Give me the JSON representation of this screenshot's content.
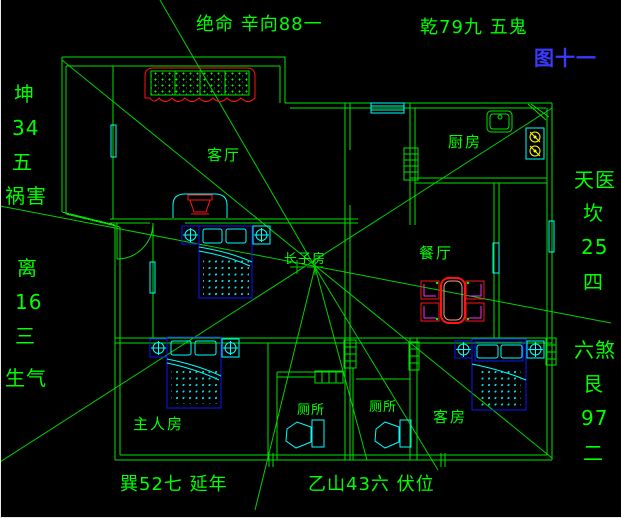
{
  "annotations": {
    "top_left": "绝命 辛向88一",
    "top_right": "乾79九 五鬼",
    "figure_no": "图十一",
    "bottom_left": "巽52七 延年",
    "bottom_right": "乙山43六 伏位",
    "left_upper": [
      "坤",
      "34",
      "五",
      "祸害"
    ],
    "left_lower": [
      "离",
      "16",
      "三",
      "生气"
    ],
    "right_upper": [
      "天医",
      "坎",
      "25",
      "四"
    ],
    "right_lower": [
      "六煞",
      "艮",
      "97",
      "二"
    ]
  },
  "rooms": {
    "living_room": "客厅",
    "kitchen": "厨房",
    "dining_room": "餐厅",
    "eldest_son_room": "长子房",
    "master_bedroom": "主人房",
    "toilet_left": "厕所",
    "toilet_right": "厕所",
    "guest_room": "客房"
  },
  "colors": {
    "background": "#000000",
    "wall_green": "#00e400",
    "text_green": "#00ff00",
    "figure_blue": "#3a3aff",
    "furniture_blue": "#1414ff",
    "cyan": "#00ffff",
    "red": "#ff1414",
    "magenta": "#ff28ff",
    "yellow": "#ffff00"
  }
}
